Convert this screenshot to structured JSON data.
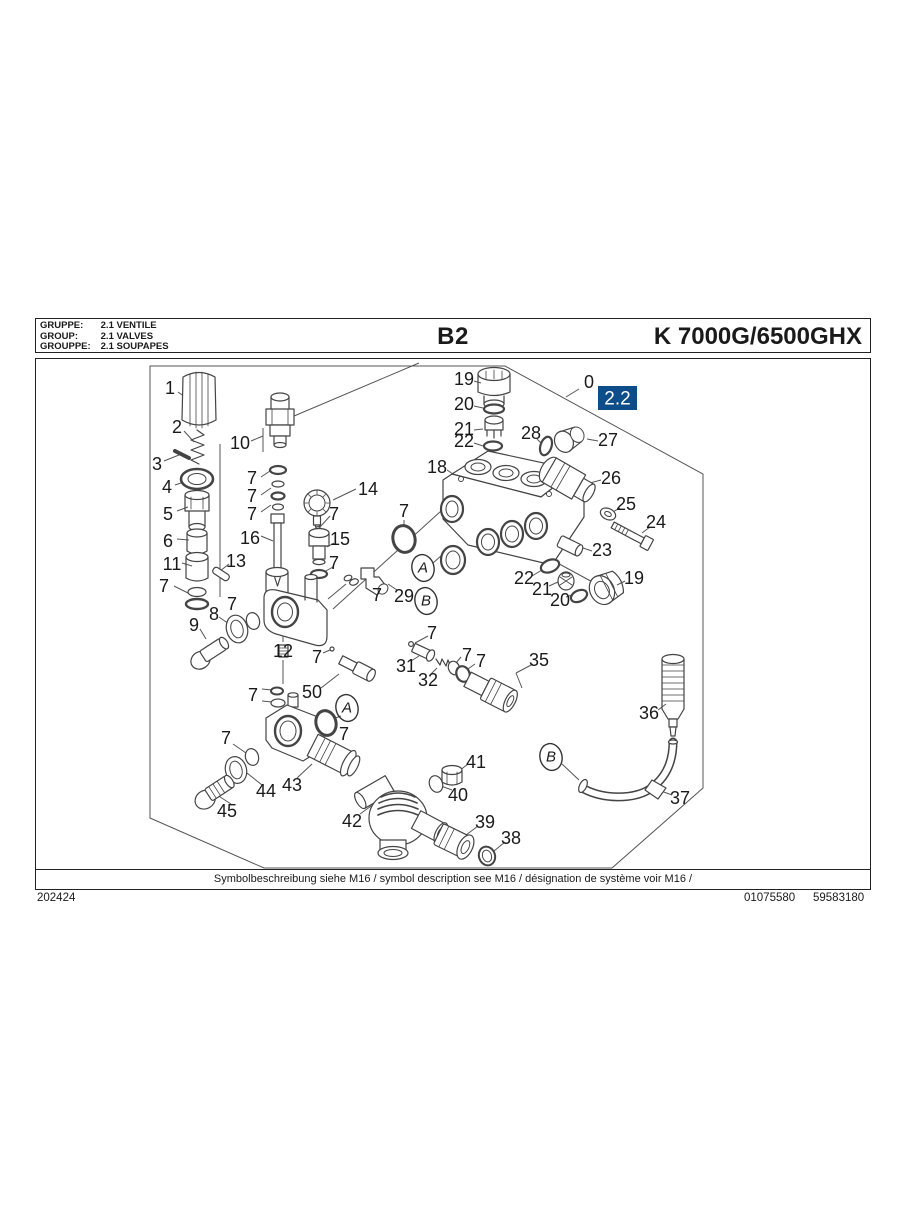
{
  "header": {
    "rows": [
      {
        "label": "GRUPPE:",
        "value": "2.1  VENTILE"
      },
      {
        "label": "GROUP:",
        "value": "2.1  VALVES"
      },
      {
        "label": "GROUPPE:",
        "value": "2.1  SOUPAPES"
      }
    ],
    "page_code": "B2",
    "model": "K 7000G/6500GHX"
  },
  "diagram": {
    "section_badge": "2.2",
    "callouts": [
      {
        "n": "1",
        "x": 170,
        "y": 388
      },
      {
        "n": "2",
        "x": 177,
        "y": 427
      },
      {
        "n": "3",
        "x": 157,
        "y": 464
      },
      {
        "n": "4",
        "x": 167,
        "y": 487
      },
      {
        "n": "5",
        "x": 168,
        "y": 514
      },
      {
        "n": "6",
        "x": 168,
        "y": 541
      },
      {
        "n": "11",
        "x": 172,
        "y": 564
      },
      {
        "n": "13",
        "x": 236,
        "y": 561
      },
      {
        "n": "7",
        "x": 164,
        "y": 586
      },
      {
        "n": "10",
        "x": 240,
        "y": 443
      },
      {
        "n": "7",
        "x": 252,
        "y": 478
      },
      {
        "n": "7",
        "x": 252,
        "y": 496
      },
      {
        "n": "7",
        "x": 252,
        "y": 514
      },
      {
        "n": "16",
        "x": 250,
        "y": 538
      },
      {
        "n": "14",
        "x": 368,
        "y": 489
      },
      {
        "n": "7",
        "x": 334,
        "y": 514
      },
      {
        "n": "15",
        "x": 340,
        "y": 539
      },
      {
        "n": "7",
        "x": 334,
        "y": 563
      },
      {
        "n": "8",
        "x": 214,
        "y": 614
      },
      {
        "n": "7",
        "x": 232,
        "y": 604
      },
      {
        "n": "9",
        "x": 194,
        "y": 625
      },
      {
        "n": "12",
        "x": 283,
        "y": 651
      },
      {
        "n": "7",
        "x": 404,
        "y": 511
      },
      {
        "n": "29",
        "x": 404,
        "y": 596
      },
      {
        "n": "7",
        "x": 377,
        "y": 595
      },
      {
        "n": "18",
        "x": 437,
        "y": 467
      },
      {
        "n": "19",
        "x": 464,
        "y": 379
      },
      {
        "n": "20",
        "x": 464,
        "y": 404
      },
      {
        "n": "21",
        "x": 464,
        "y": 429
      },
      {
        "n": "22",
        "x": 464,
        "y": 441
      },
      {
        "n": "28",
        "x": 531,
        "y": 433
      },
      {
        "n": "27",
        "x": 608,
        "y": 440
      },
      {
        "n": "26",
        "x": 611,
        "y": 478
      },
      {
        "n": "25",
        "x": 626,
        "y": 504
      },
      {
        "n": "24",
        "x": 656,
        "y": 522
      },
      {
        "n": "23",
        "x": 602,
        "y": 550
      },
      {
        "n": "22",
        "x": 524,
        "y": 578
      },
      {
        "n": "21",
        "x": 542,
        "y": 589
      },
      {
        "n": "20",
        "x": 560,
        "y": 600
      },
      {
        "n": "19",
        "x": 634,
        "y": 578
      },
      {
        "n": "0",
        "x": 589,
        "y": 382
      },
      {
        "n": "7",
        "x": 317,
        "y": 657
      },
      {
        "n": "7",
        "x": 253,
        "y": 695
      },
      {
        "n": "50",
        "x": 312,
        "y": 692
      },
      {
        "n": "31",
        "x": 406,
        "y": 666
      },
      {
        "n": "32",
        "x": 428,
        "y": 680
      },
      {
        "n": "7",
        "x": 432,
        "y": 633
      },
      {
        "n": "7",
        "x": 467,
        "y": 655
      },
      {
        "n": "7",
        "x": 481,
        "y": 661
      },
      {
        "n": "35",
        "x": 539,
        "y": 660
      },
      {
        "n": "7",
        "x": 344,
        "y": 734
      },
      {
        "n": "7",
        "x": 226,
        "y": 738
      },
      {
        "n": "44",
        "x": 266,
        "y": 791
      },
      {
        "n": "43",
        "x": 292,
        "y": 785
      },
      {
        "n": "45",
        "x": 227,
        "y": 811
      },
      {
        "n": "42",
        "x": 352,
        "y": 821
      },
      {
        "n": "41",
        "x": 476,
        "y": 762
      },
      {
        "n": "40",
        "x": 458,
        "y": 795
      },
      {
        "n": "39",
        "x": 485,
        "y": 822
      },
      {
        "n": "38",
        "x": 511,
        "y": 838
      },
      {
        "n": "36",
        "x": 649,
        "y": 713
      },
      {
        "n": "37",
        "x": 680,
        "y": 798
      }
    ],
    "markers": [
      {
        "label": "A",
        "x": 423,
        "y": 568
      },
      {
        "label": "A",
        "x": 347,
        "y": 708
      },
      {
        "label": "B",
        "x": 426,
        "y": 601
      },
      {
        "label": "B",
        "x": 551,
        "y": 757
      }
    ]
  },
  "footer": {
    "symbol_note": "Symbolbeschreibung siehe M16 / symbol description see M16 / désignation de système voir M16 /",
    "doc_number": "202424",
    "ref_left": "01075580",
    "ref_right": "59583180"
  },
  "colors": {
    "badge_bg": "#0d4d8a",
    "badge_text": "#ffffff",
    "line": "#444444",
    "text": "#1a1a1a"
  }
}
